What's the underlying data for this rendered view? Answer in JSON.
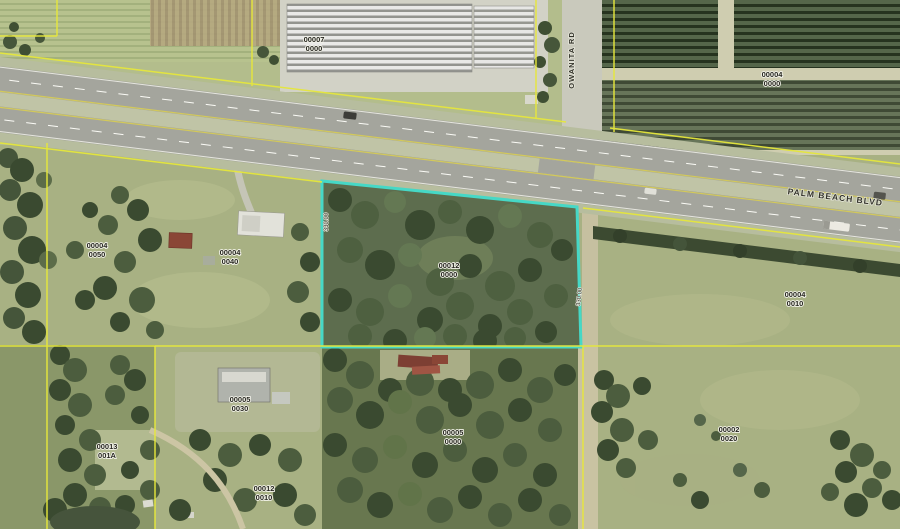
{
  "map": {
    "colors": {
      "highlight_stroke": "#46d8c6",
      "parcel_line": "#e6e73c"
    },
    "road_labels": {
      "palm_beach_blvd": "PALM BEACH BLVD",
      "owanita_rd": "OWANITA RD"
    },
    "dimension_labels": {
      "west": "330.00",
      "east": "330.00"
    },
    "highlighted_parcel_index": 5,
    "parcels": [
      {
        "block": "00007",
        "lot": "0000"
      },
      {
        "block": "00004",
        "lot": "0000"
      },
      {
        "block": "00004",
        "lot": "0010"
      },
      {
        "block": "00004",
        "lot": "0050"
      },
      {
        "block": "00004",
        "lot": "0040"
      },
      {
        "block": "00012",
        "lot": "0000"
      },
      {
        "block": "00005",
        "lot": "0030"
      },
      {
        "block": "00005",
        "lot": "0000"
      },
      {
        "block": "00013",
        "lot": "001A"
      },
      {
        "block": "00012",
        "lot": "0010"
      },
      {
        "block": "00002",
        "lot": "0020"
      }
    ]
  }
}
